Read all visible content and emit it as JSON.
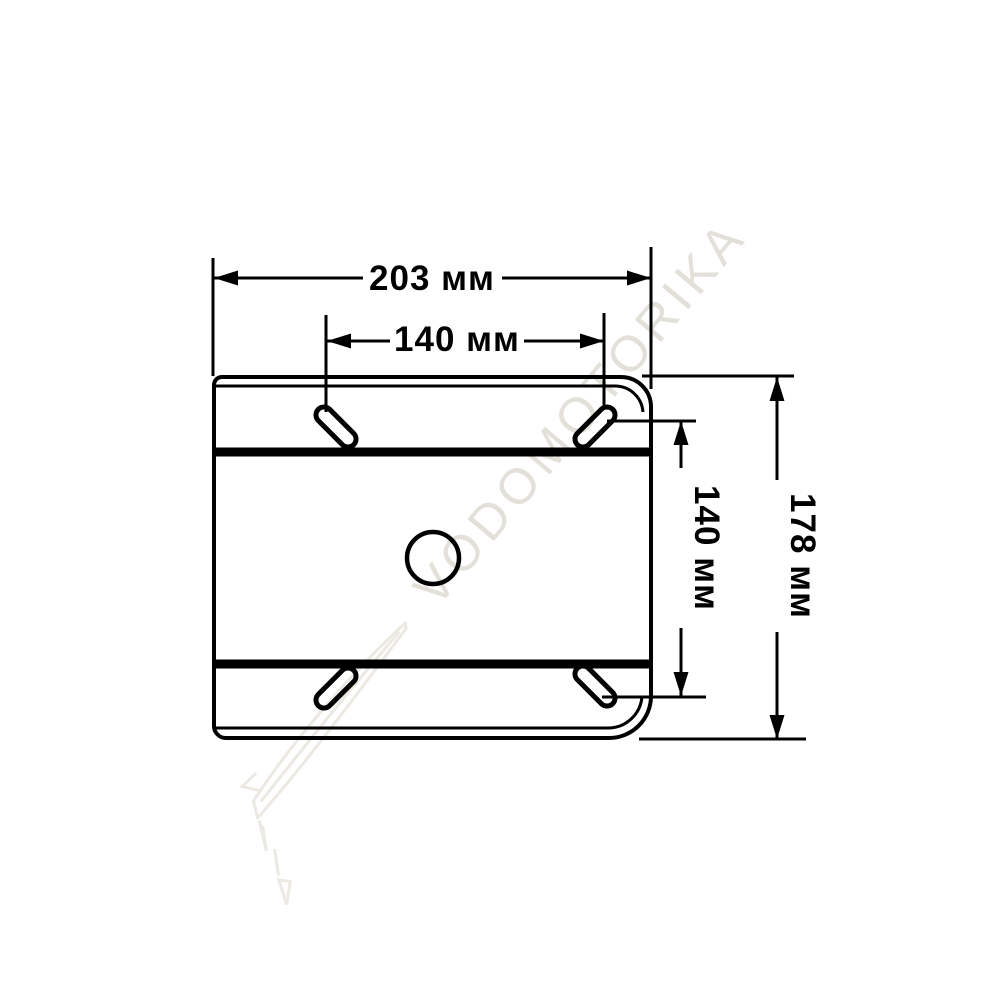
{
  "colors": {
    "ink": "#000000",
    "background": "#ffffff",
    "watermark": "#e3e0da",
    "watermark_sketch": "#ece9e3"
  },
  "watermark": {
    "text": "VODOMOTORIKA"
  },
  "drawing": {
    "dim_width_total": "203 мм",
    "dim_slot_spacing_x": "140 мм",
    "dim_slot_spacing_y": "140 мм",
    "dim_height_total": "178 мм"
  }
}
